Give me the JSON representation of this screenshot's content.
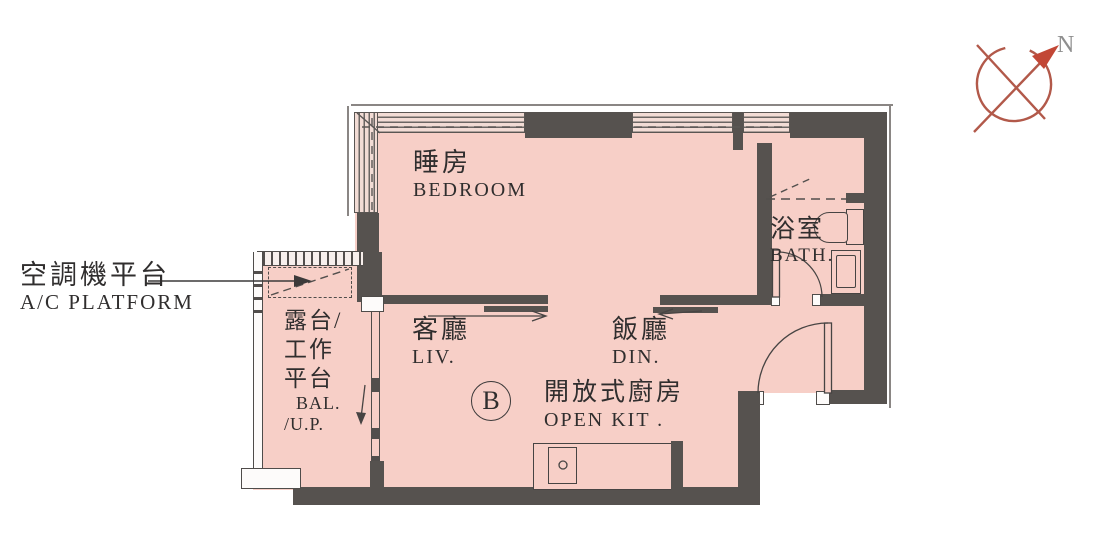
{
  "plan": {
    "unit_label": "B",
    "compass": {
      "north_label": "N"
    },
    "rooms": {
      "bedroom": {
        "zh": "睡房",
        "en": "BEDROOM"
      },
      "living": {
        "zh": "客廳",
        "en": "LIV."
      },
      "dining": {
        "zh": "飯廳",
        "en": "DIN."
      },
      "open_kitchen": {
        "zh": "開放式廚房",
        "en": "OPEN KIT ."
      },
      "bath": {
        "zh": "浴室",
        "en": "BATH."
      },
      "balcony": {
        "zh_line1": "露台/",
        "zh_line2": "工作",
        "zh_line3": "平台",
        "en_line1": "BAL.",
        "en_line2": "/U.P."
      }
    },
    "annotations": {
      "ac_platform": {
        "zh": "空調機平台",
        "en": "A/C PLATFORM"
      }
    },
    "colors": {
      "floor_fill": "#f7cfc7",
      "wall": "#56524f",
      "compass_accent": "#b2594a",
      "text": "#302e2e"
    }
  }
}
